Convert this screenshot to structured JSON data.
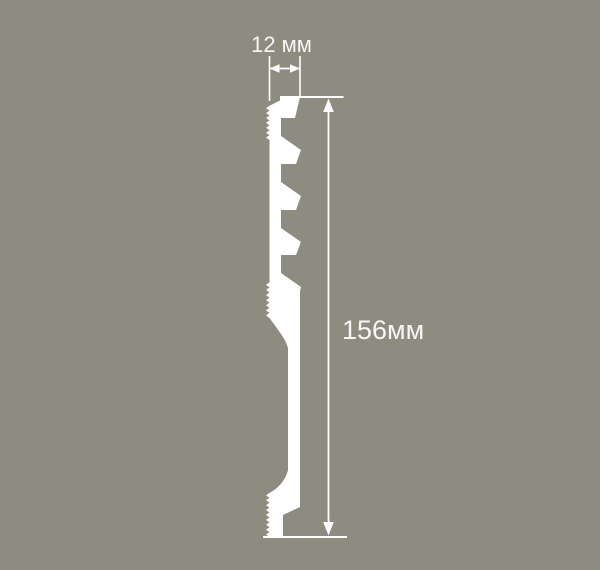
{
  "diagram": {
    "type": "skirting-profile-cross-section-drawing",
    "width_label": "12 мм",
    "height_label": "156мм",
    "dimensions": {
      "width_mm": 12,
      "height_mm": 156
    },
    "colors": {
      "background": "#8e8b81",
      "line": "#ffffff",
      "text": "#f6f6f3"
    }
  }
}
